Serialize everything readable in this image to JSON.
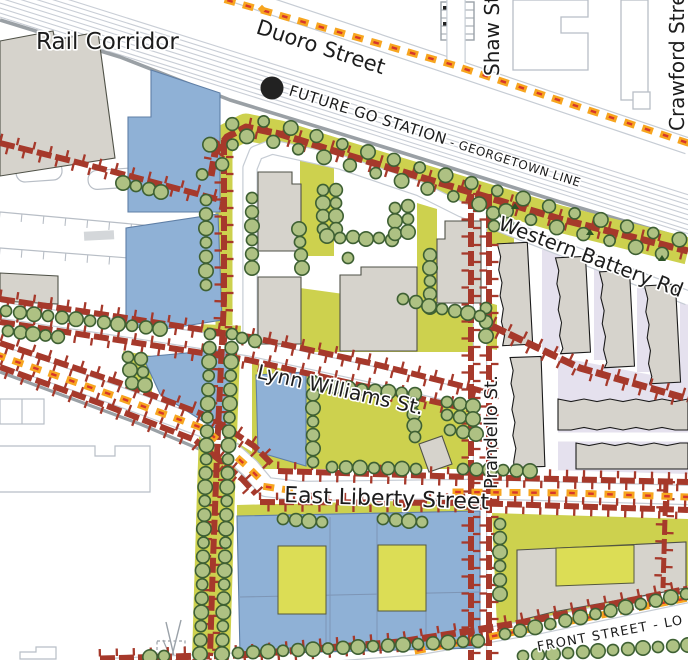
{
  "map_title": "Liberty Village area plan map",
  "labels": {
    "rail_corridor": "Rail Corridor",
    "duoro_street": "Duoro Street",
    "shaw_street": "Shaw Street",
    "crawford_street": "Crawford Street",
    "future_go_station": "FUTURE GO STATION",
    "georgetown_line": " - GEORGETOWN LINE",
    "western_battery_rd": "Western Battery Rd",
    "lynn_williams_st": "Lynn Williams St.",
    "prandello_st": "Prandello St.",
    "east_liberty_street": "East Liberty Street",
    "front_street": "FRONT STREET - LO"
  },
  "go_station_marker": {
    "shape": "filled-circle",
    "color": "#222222"
  },
  "palette": {
    "road_red": "#a6392b",
    "olive": "#cdd14e",
    "courtyard_yellow": "#dcdd55",
    "building_blue": "#8fb1d6",
    "building_blue_stroke": "#5f7fa6",
    "building_gray": "#d6d3cc",
    "building_gray_stroke": "#4f5147",
    "townhouse_stroke": "#1b1b1b",
    "lavender": "#e5e1ee",
    "tree_fill": "#aec183",
    "tree_stroke": "#3e6033",
    "rail_line": "#c9ced6",
    "rail_thick": "#9aa0a5",
    "road_casing": "#c6ccd4",
    "bike_orange": "#f7a51f",
    "bike_red": "#d6372b",
    "label_color": "#1c1c1c",
    "faint_outline": "#b8bec6",
    "white": "#ffffff"
  }
}
